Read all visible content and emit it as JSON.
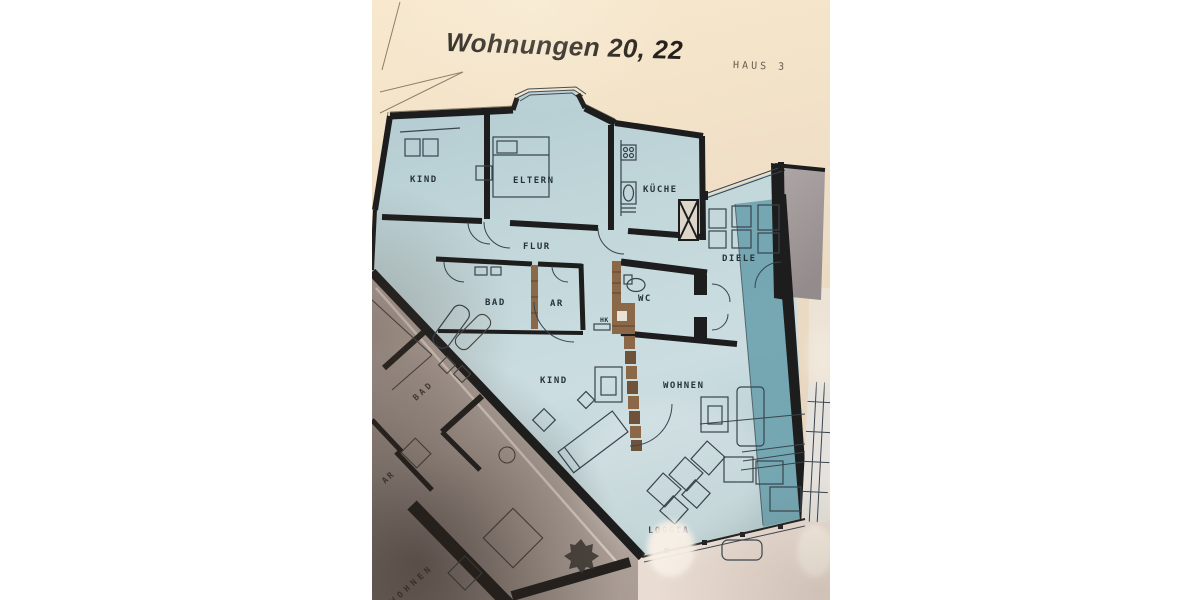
{
  "photo": {
    "title": "Wohnungen 20, 22",
    "building_label": "HAUS 3",
    "apartment": {
      "rooms": [
        {
          "id": "kind-top",
          "label": "KIND"
        },
        {
          "id": "eltern",
          "label": "ELTERN"
        },
        {
          "id": "kueche",
          "label": "KÜCHE"
        },
        {
          "id": "flur",
          "label": "FLUR"
        },
        {
          "id": "bad",
          "label": "BAD"
        },
        {
          "id": "ar",
          "label": "AR"
        },
        {
          "id": "wc",
          "label": "WC"
        },
        {
          "id": "hk",
          "label": "HK"
        },
        {
          "id": "diele",
          "label": "DIELE"
        },
        {
          "id": "kind-bottom",
          "label": "KIND"
        },
        {
          "id": "wohnen",
          "label": "WOHNEN"
        },
        {
          "id": "loggia",
          "label": "LOGGIA"
        }
      ]
    },
    "neighbor_apartment": {
      "rooms": [
        {
          "id": "n-bad",
          "label": "BAD"
        },
        {
          "id": "n-ar",
          "label": "AR"
        },
        {
          "id": "n-wohnen",
          "label": "WOHNEN"
        }
      ]
    },
    "colors": {
      "title-ink": "#241f1a",
      "annotation-ink": "#655b4e",
      "wall-ink": "#1d1d1d",
      "line-ink": "#39444e",
      "label-ink": "#27323b",
      "plan-blue": "#bfd5d9",
      "plan-teal": "#6ea3af",
      "brown-wall": "#8a6848",
      "gray-block": "#a49b9a",
      "neighbor-paper": "#b5a8a0",
      "pale-bottom": "#e9dcd2",
      "paper-cream": "#f3e3c9"
    }
  }
}
